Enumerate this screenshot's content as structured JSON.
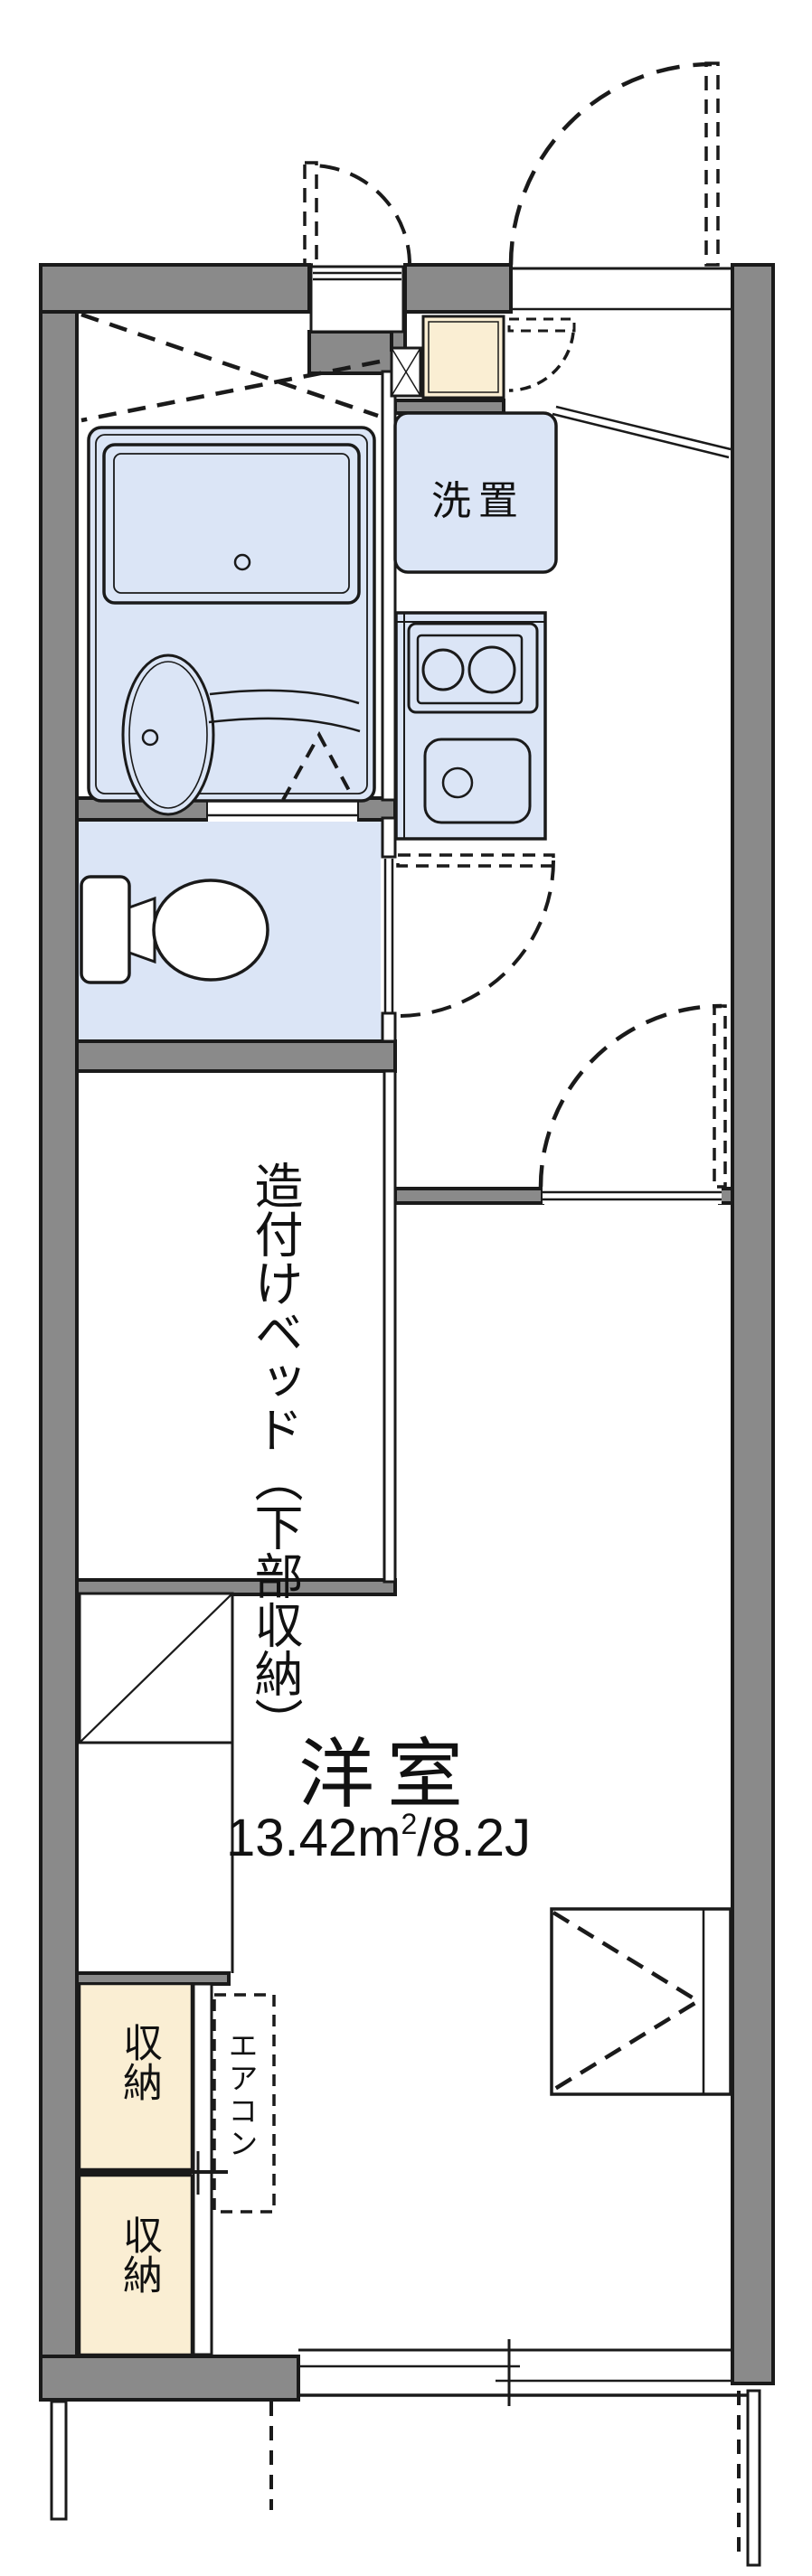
{
  "plan": {
    "labels": {
      "washer": "洗置",
      "bed_line1": "造付けベッド",
      "bed_line2": "（下部収納）",
      "room_name": "洋室",
      "area_value": "13.42",
      "area_unit": "m",
      "area_exp": "2",
      "area_rest": "/8.2J",
      "storage_upper": "収納",
      "storage_lower": "収納",
      "aircon": "エアコン"
    },
    "colors": {
      "wall_gray": "#8a8a8a",
      "line_black": "#1a1a1a",
      "wet_area_blue": "#dbe5f6",
      "storage_cream": "#faeed3",
      "background": "#ffffff"
    }
  }
}
